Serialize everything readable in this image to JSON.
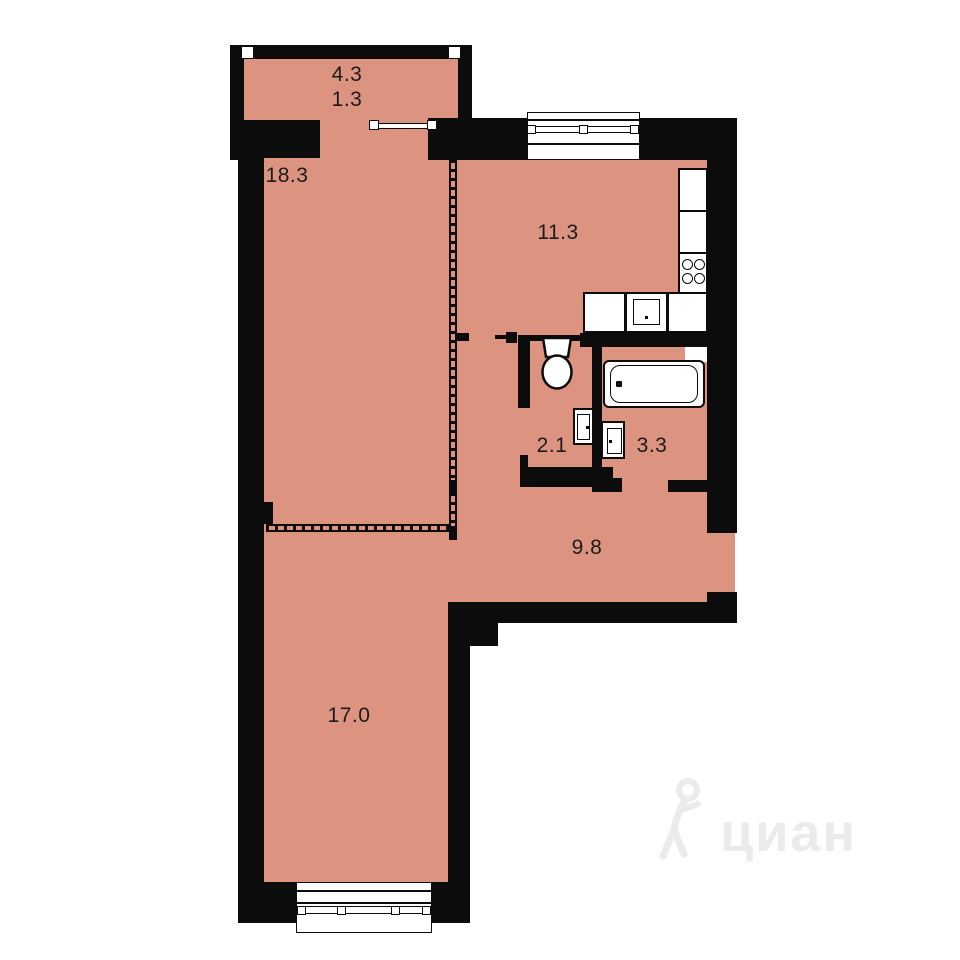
{
  "plan": {
    "type": "apartment-floor-plan",
    "rooms": {
      "balcony": {
        "area_total": "4.3",
        "area_reduced": "1.3"
      },
      "living_room": {
        "area": "18.3"
      },
      "kitchen": {
        "area": "11.3"
      },
      "toilet": {
        "area": "2.1"
      },
      "bathroom": {
        "area": "3.3"
      },
      "hallway": {
        "area": "9.8"
      },
      "bedroom": {
        "area": "17.0"
      }
    },
    "fixtures": [
      "toilet",
      "bathtub",
      "washbasin",
      "washbasin",
      "kitchen-counter",
      "stove-4-burner",
      "kitchen-sink",
      "window",
      "window",
      "balcony-glazing"
    ],
    "colors": {
      "floor": "#dc9480",
      "wall": "#0c0c0c",
      "fixture": "#ffffff",
      "watermark": "#ebebeb",
      "label": "#1b1b1b"
    }
  },
  "watermark": {
    "brand": "циан"
  }
}
